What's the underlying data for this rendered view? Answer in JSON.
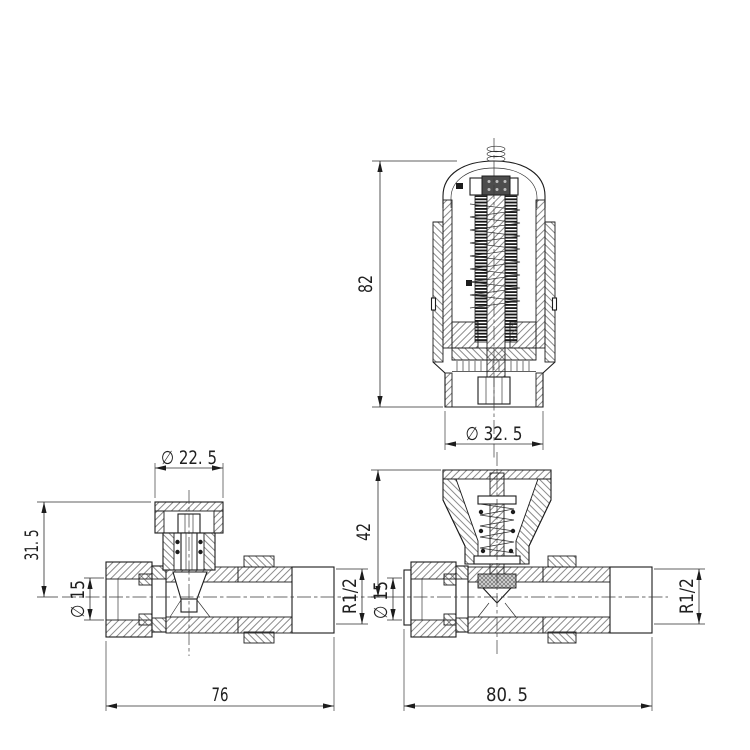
{
  "colors": {
    "line": "#1c1c1c",
    "background": "#ffffff"
  },
  "views": {
    "thermostatic_head": {
      "dim_height": "82",
      "dim_diameter": "∅ 32. 5"
    },
    "straight_valve": {
      "dim_cap_diameter": "∅ 22. 5",
      "dim_height_to_centre": "31. 5",
      "dim_inlet_diameter": "∅ 15",
      "dim_outlet_thread": "R1/2",
      "dim_length": "76"
    },
    "trv_body": {
      "dim_height_to_centre": "42",
      "dim_inlet_diameter": "∅ 15",
      "dim_outlet_thread": "R1/2",
      "dim_length": "80. 5"
    }
  }
}
